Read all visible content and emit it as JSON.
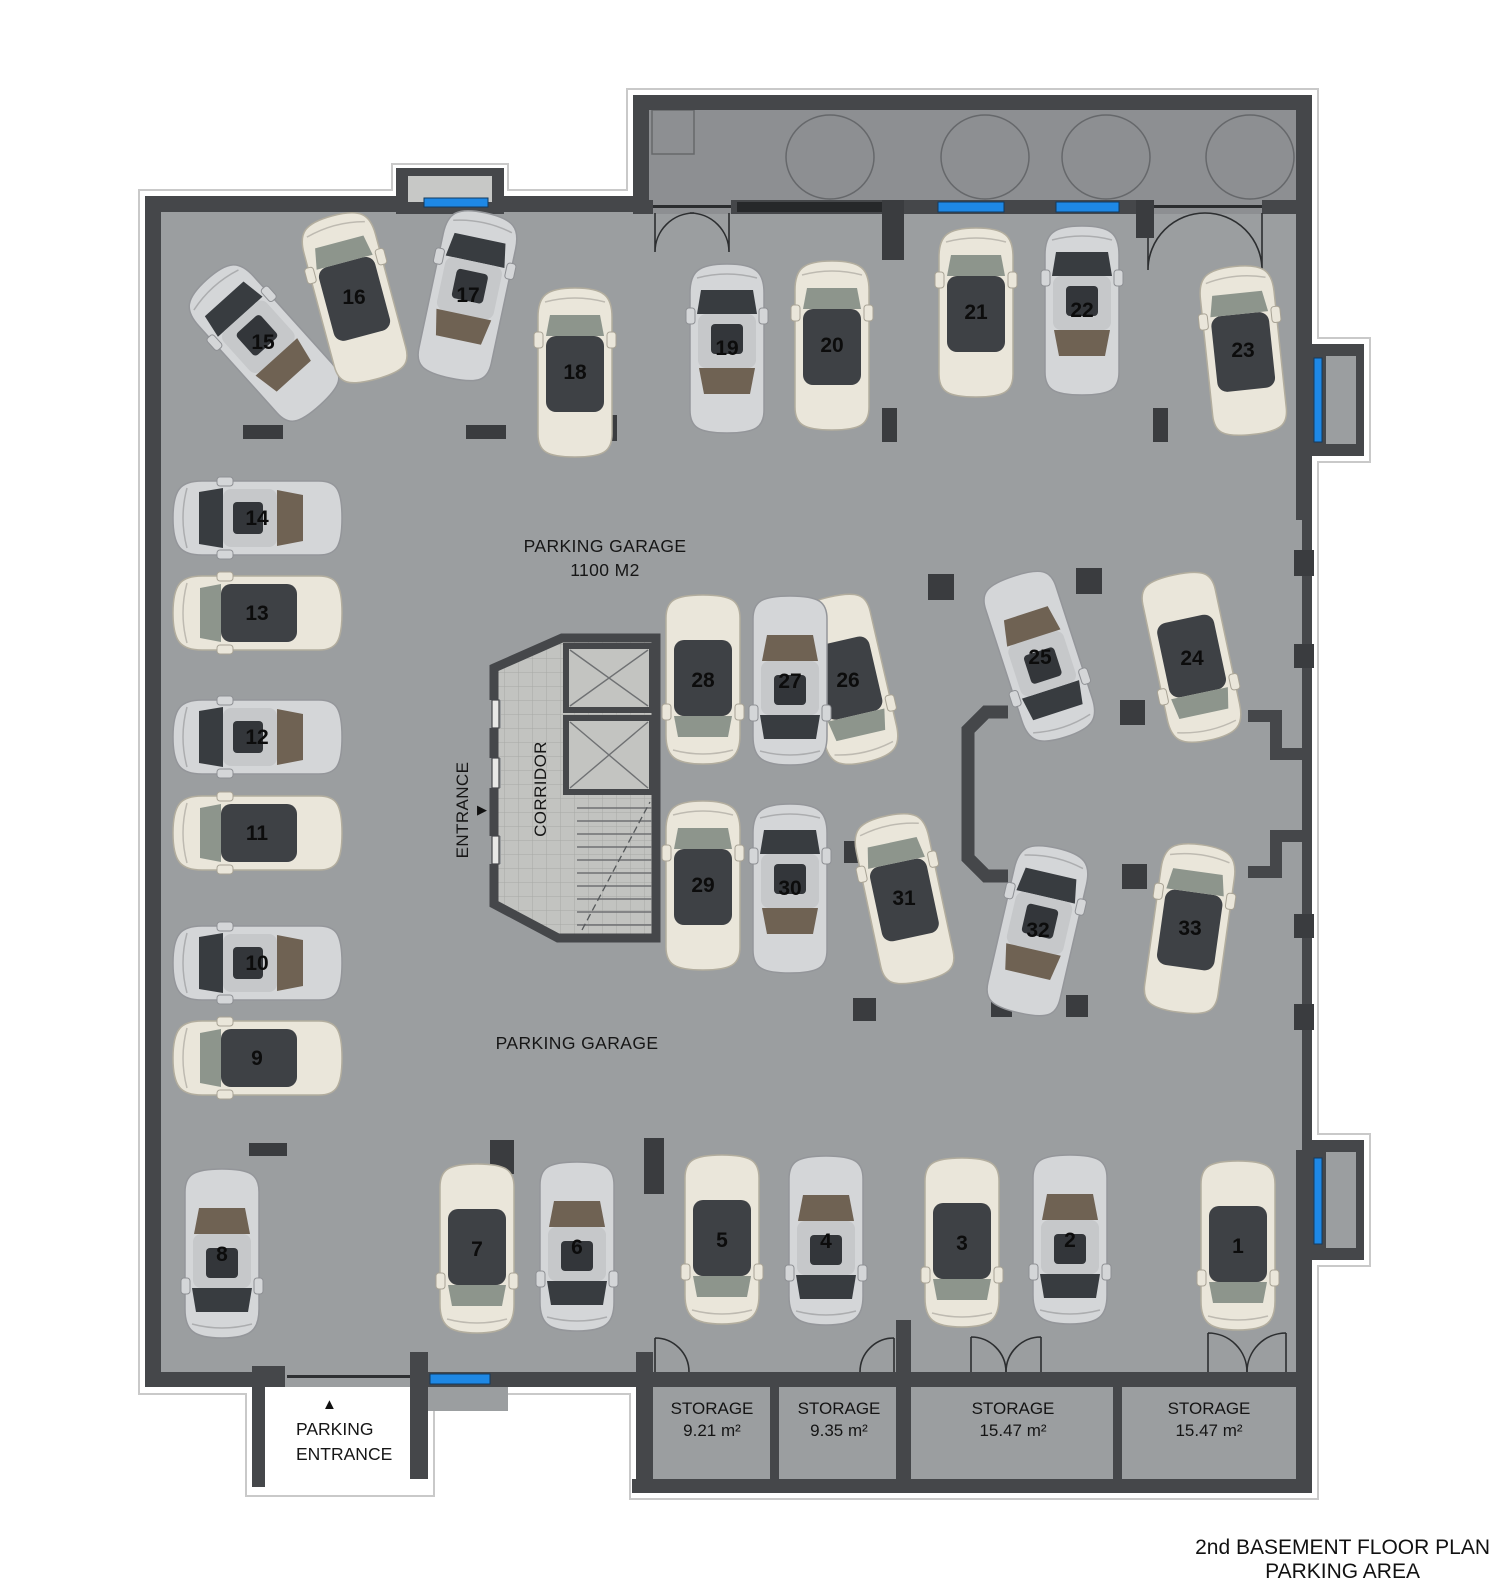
{
  "page": {
    "title_line1": "2nd BASEMENT FLOOR PLAN",
    "title_line2": "PARKING AREA"
  },
  "labels": {
    "garage_area_line1": "PARKING GARAGE",
    "garage_area_line2": "1100 M2",
    "garage_lower": "PARKING GARAGE",
    "entrance": "ENTRANCE",
    "corridor": "CORRIDOR",
    "parking_entrance_line1": "PARKING",
    "parking_entrance_line2": "ENTRANCE"
  },
  "icons": {
    "entrance_arrow": "▶",
    "parking_entrance_arrow": "▲"
  },
  "storage_rooms": [
    {
      "label": "STORAGE",
      "area": "9.21 m²",
      "cx": 712,
      "cy": 1398
    },
    {
      "label": "STORAGE",
      "area": "9.35 m²",
      "cx": 839,
      "cy": 1398
    },
    {
      "label": "STORAGE",
      "area": "15.47 m²",
      "cx": 1013,
      "cy": 1398
    },
    {
      "label": "STORAGE",
      "area": "15.47 m²",
      "cx": 1209,
      "cy": 1398
    }
  ],
  "parking_spots": [
    {
      "number": "1",
      "x": 1238,
      "y": 1246,
      "rotation": 180,
      "car_color": "cream"
    },
    {
      "number": "2",
      "x": 1070,
      "y": 1240,
      "rotation": 180,
      "car_color": "silver"
    },
    {
      "number": "3",
      "x": 962,
      "y": 1243,
      "rotation": 180,
      "car_color": "cream"
    },
    {
      "number": "4",
      "x": 826,
      "y": 1241,
      "rotation": 180,
      "car_color": "silver"
    },
    {
      "number": "5",
      "x": 722,
      "y": 1240,
      "rotation": 180,
      "car_color": "cream"
    },
    {
      "number": "6",
      "x": 577,
      "y": 1247,
      "rotation": 180,
      "car_color": "silver"
    },
    {
      "number": "7",
      "x": 477,
      "y": 1249,
      "rotation": 180,
      "car_color": "cream"
    },
    {
      "number": "8",
      "x": 222,
      "y": 1254,
      "rotation": 180,
      "car_color": "silver"
    },
    {
      "number": "9",
      "x": 257,
      "y": 1058,
      "rotation": -90,
      "car_color": "cream"
    },
    {
      "number": "10",
      "x": 257,
      "y": 963,
      "rotation": -90,
      "car_color": "silver"
    },
    {
      "number": "11",
      "x": 257,
      "y": 833,
      "rotation": -90,
      "car_color": "cream"
    },
    {
      "number": "12",
      "x": 257,
      "y": 737,
      "rotation": -90,
      "car_color": "silver"
    },
    {
      "number": "13",
      "x": 257,
      "y": 613,
      "rotation": -90,
      "car_color": "cream"
    },
    {
      "number": "14",
      "x": 257,
      "y": 518,
      "rotation": -90,
      "car_color": "silver"
    },
    {
      "number": "15",
      "x": 263,
      "y": 342,
      "rotation": -42,
      "car_color": "silver"
    },
    {
      "number": "16",
      "x": 354,
      "y": 297,
      "rotation": -15,
      "car_color": "cream"
    },
    {
      "number": "17",
      "x": 468,
      "y": 295,
      "rotation": 12,
      "car_color": "silver"
    },
    {
      "number": "18",
      "x": 575,
      "y": 372,
      "rotation": 0,
      "car_color": "cream"
    },
    {
      "number": "19",
      "x": 727,
      "y": 348,
      "rotation": 0,
      "car_color": "silver"
    },
    {
      "number": "20",
      "x": 832,
      "y": 345,
      "rotation": 0,
      "car_color": "cream"
    },
    {
      "number": "21",
      "x": 976,
      "y": 312,
      "rotation": 0,
      "car_color": "cream"
    },
    {
      "number": "22",
      "x": 1082,
      "y": 310,
      "rotation": 0,
      "car_color": "silver"
    },
    {
      "number": "23",
      "x": 1243,
      "y": 350,
      "rotation": -6,
      "car_color": "cream"
    },
    {
      "number": "24",
      "x": 1192,
      "y": 658,
      "rotation": 168,
      "car_color": "cream"
    },
    {
      "number": "25",
      "x": 1040,
      "y": 657,
      "rotation": 162,
      "car_color": "silver"
    },
    {
      "number": "26",
      "x": 848,
      "y": 680,
      "rotation": 167,
      "car_color": "cream"
    },
    {
      "number": "27",
      "x": 790,
      "y": 681,
      "rotation": 180,
      "car_color": "silver"
    },
    {
      "number": "28",
      "x": 703,
      "y": 680,
      "rotation": 180,
      "car_color": "cream"
    },
    {
      "number": "29",
      "x": 703,
      "y": 885,
      "rotation": 0,
      "car_color": "cream"
    },
    {
      "number": "30",
      "x": 790,
      "y": 888,
      "rotation": 0,
      "car_color": "silver"
    },
    {
      "number": "31",
      "x": 904,
      "y": 898,
      "rotation": -12,
      "car_color": "cream"
    },
    {
      "number": "32",
      "x": 1038,
      "y": 930,
      "rotation": 13,
      "car_color": "silver"
    },
    {
      "number": "33",
      "x": 1190,
      "y": 928,
      "rotation": 8,
      "car_color": "cream"
    }
  ],
  "colors": {
    "floor": "#9b9ea0",
    "room_floor": "#8d8f92",
    "storage_floor": "#9b9ea0",
    "corridor_floor": "#c2c3c0",
    "wall": "#45474a",
    "column": "#3a3c3f",
    "window_blue": "#1e88e5",
    "dark_window": "#26282a",
    "car_cream": "#eae6da",
    "car_silver": "#d4d6d8",
    "glass_dark": "#3e4145",
    "glass_front": "#8d958c",
    "rear_brown": "#6f6253",
    "text": "#161616"
  }
}
